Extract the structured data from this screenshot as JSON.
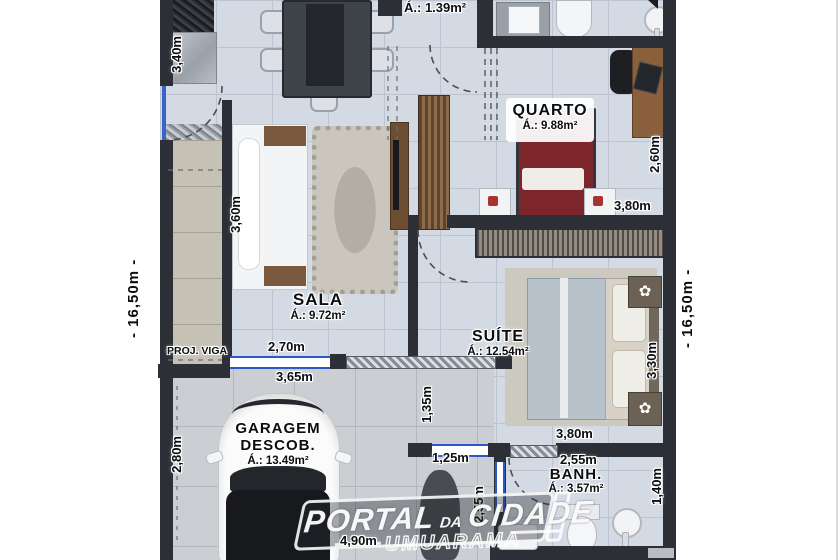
{
  "plan": {
    "rooms": {
      "top_bath": {
        "area": "Á.: 1.39m²"
      },
      "quarto": {
        "name": "QUARTO",
        "area": "Á.: 9.88m²"
      },
      "sala": {
        "name": "SALA",
        "area": "Á.: 9.72m²"
      },
      "suite": {
        "name": "SUÍTE",
        "area": "Á.: 12.54m²"
      },
      "garagem": {
        "name": "GARAGEM",
        "name2": "DESCOB.",
        "area": "Á.: 13.49m²"
      },
      "banh": {
        "name": "BANH.",
        "area": "Á.: 3.57m²"
      }
    },
    "annotations": {
      "proj_viga": "PROJ. VIGA"
    },
    "dimensions": {
      "total_left": "-  16,50m  -",
      "total_right": "-  16,50m  -",
      "d340": "3,40m",
      "d360": "3,60m",
      "d260": "2,60m",
      "d380_quarto": "3,80m",
      "d270": "2,70m",
      "d365": "3,65m",
      "d135": "1,35m",
      "d330": "3,30m",
      "d380_suite": "3,80m",
      "d280": "2,80m",
      "d125": "1,25m",
      "d255": "2,55m",
      "d255_v": "2,55m",
      "d140": "1,40m",
      "d490": "4,90m"
    },
    "watermark": {
      "part1": "PORTAL",
      "part2": "DA",
      "part3": "CIDADE",
      "subtitle": "UMUARAMA"
    },
    "colors": {
      "wall": "#2c2f36",
      "floor": "#d4dae3",
      "window_blue": "#2b57c8",
      "bed_red": "#7c262b",
      "wood": "#7d5a3d"
    }
  }
}
